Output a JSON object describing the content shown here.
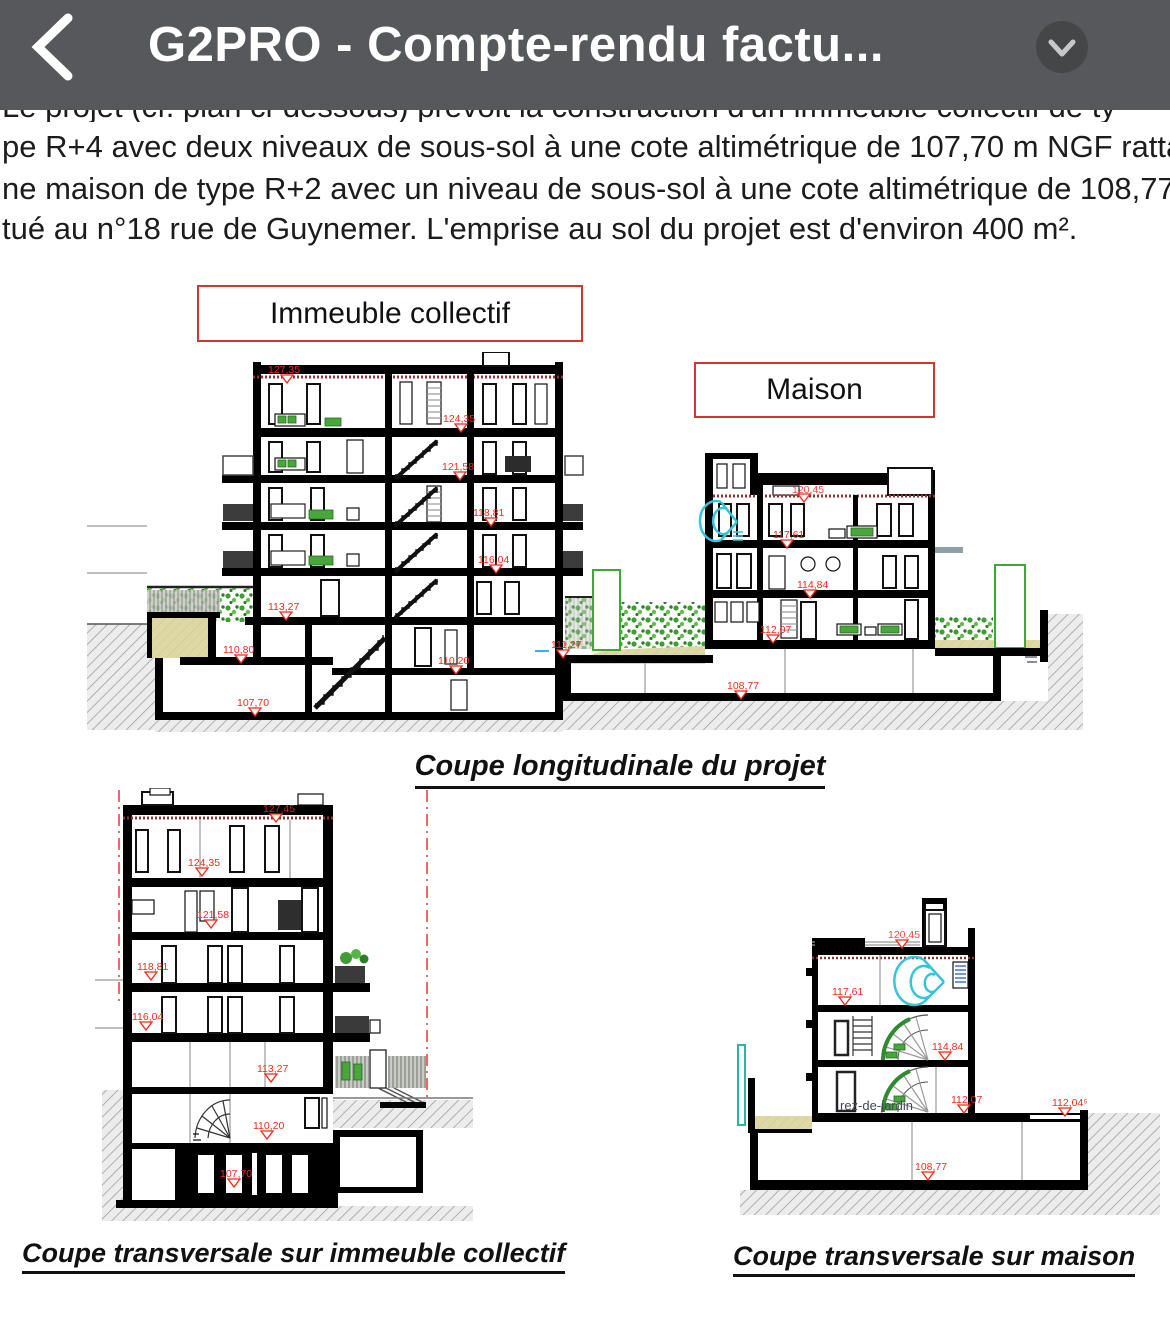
{
  "header": {
    "title": "G2PRO - Compte-rendu factu..."
  },
  "text": {
    "clipped_line": "Le projet (cf. plan ci-dessous) prévoit la construction d'un immeuble collectif de ty",
    "line1": "pe R+4 avec deux niveaux de sous-sol à une cote altimétrique de 107,70 m NGF rattaché",
    "line2": "ne maison de type R+2 avec un niveau de sous-sol à une cote altimétrique de 108,77 m",
    "line3": "tué au n°18 rue de Guynemer. L'emprise au sol du projet est d'environ 400 m²."
  },
  "boxes": {
    "immeuble": "Immeuble collectif",
    "maison": "Maison"
  },
  "captions": {
    "longitudinale": "Coupe longitudinale du projet",
    "transversale_immeuble": "Coupe transversale sur immeuble collectif",
    "transversale_maison": "Coupe transversale sur maison"
  },
  "elev": {
    "li": {
      "roof": "127,35",
      "f4": "124,35",
      "f3": "121,58",
      "f2": "118,81",
      "f1": "116,04",
      "rdc": "113,27",
      "terrasse": "110,80",
      "ss1": "110,20",
      "ss2": "107,70",
      "cour": "111,27"
    },
    "lm": {
      "roof": "120,45",
      "f2": "117,61",
      "f1": "114,84",
      "rdc": "112,07",
      "ss": "108,77"
    },
    "ti": {
      "roof": "127,45",
      "f4": "124,35",
      "f3": "121,58",
      "f2": "118,81",
      "f1": "116,04",
      "rdc": "113,27",
      "ss1": "110,20",
      "ss2": "107,70"
    },
    "tm": {
      "roof": "120,45",
      "f2": "117,61",
      "f1": "114,84",
      "rdc": "112,07",
      "ground": "112,04⁵",
      "ss": "108,77"
    },
    "room_label": "rez-de-jardin"
  },
  "colors": {
    "topbar": "#56585b",
    "accent_red": "#ee2b1f",
    "box_border_red": "#cf3732",
    "vegetation_green": "#3f9e33",
    "soil_tan": "#ded9a4",
    "stair_cyan": "#35c4d8"
  }
}
